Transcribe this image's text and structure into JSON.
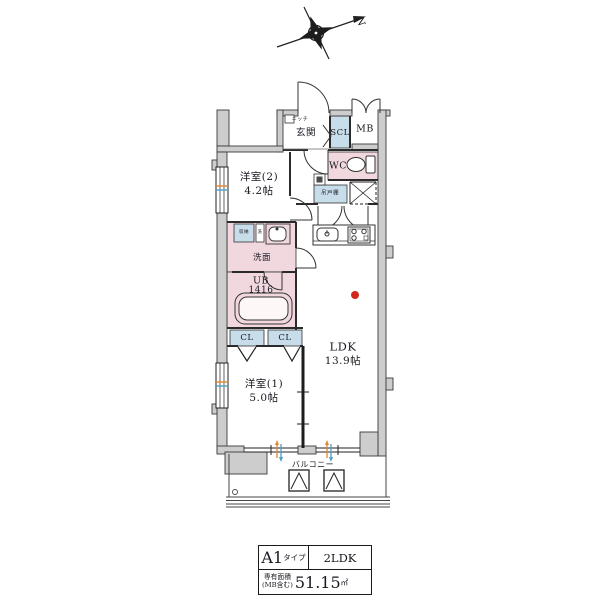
{
  "compass": {
    "north_label": "N"
  },
  "floor_plan": {
    "labels": {
      "niche": "ニッチ",
      "entrance": "玄関",
      "shoe_closet": "SCL",
      "meter_box": "MB",
      "toilet": "WC",
      "hanging_cupboard": "吊戸棚",
      "bedroom2_name": "洋室(2)",
      "bedroom2_size": "4.2帖",
      "storage": "収納",
      "laundry": "洗",
      "washroom": "洗面",
      "unit_bath_name": "UB",
      "unit_bath_size": "1416",
      "closet_left": "CL",
      "closet_right": "CL",
      "bedroom1_name": "洋室(1)",
      "bedroom1_size": "5.0帖",
      "ldk_name": "LDK",
      "ldk_size": "13.9帖",
      "balcony": "バルコニー"
    },
    "colors": {
      "wall_fill": "#cdcdcd",
      "wet_area_pink": "#f1d8de",
      "storage_blue": "#c7dde9",
      "marker_red": "#d0281c",
      "window_arrow_orange": "#e0882f",
      "window_arrow_blue": "#4d9fc4"
    },
    "icons": {
      "compass": "compass-rose",
      "toilet": "toilet-icon",
      "bathtub": "bathtub-icon",
      "kitchen_sink": "sink-icon",
      "stove": "stove-icon",
      "washbasin": "washbasin-icon",
      "evacuation_hatch": "hatch-icon"
    }
  },
  "info_table": {
    "type_value": "A1",
    "type_suffix": "タイプ",
    "layout": "2LDK",
    "area_label": "専有面積",
    "area_note": "(MB含む)",
    "area_value": "51.15",
    "area_unit": "㎡"
  }
}
